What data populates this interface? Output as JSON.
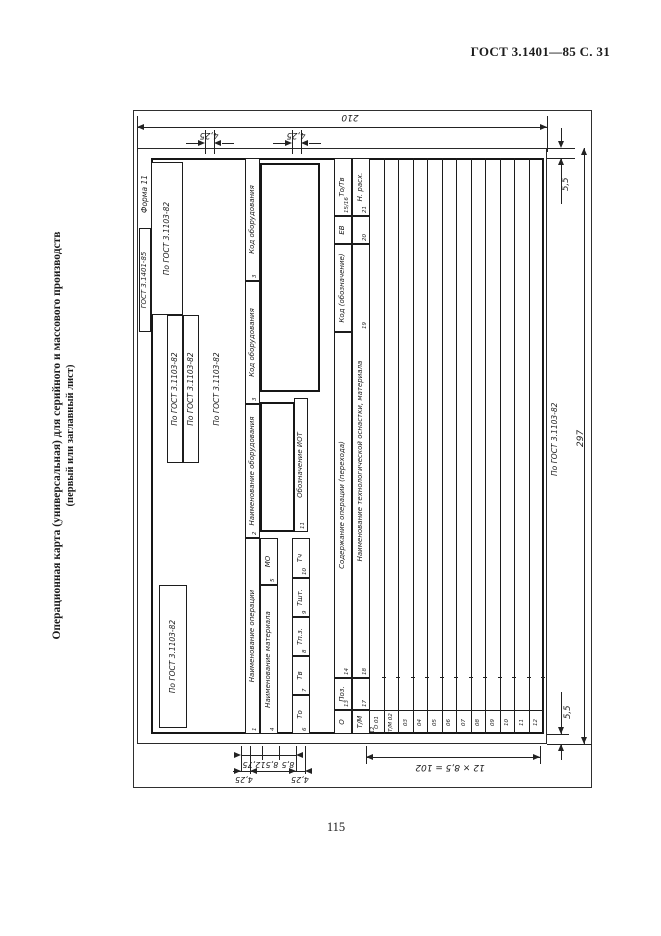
{
  "page": {
    "header": "ГОСТ 3.1401—85 С. 31",
    "page_number": "115",
    "side_title_line1": "Операционная карта (универсальная) для серийного и массового производств",
    "side_title_line2": "(первый или заглавный лист)"
  },
  "form": {
    "forma_label": "Форма 11",
    "designation_box": "ГОСТ 3.1401-85",
    "stamp_box_a": "По ГОСТ 3.1103-82",
    "stamp_box_b1": "По ГОСТ 3.1103-82",
    "stamp_box_b2": "По ГОСТ 3.1103-82",
    "stamp_box_c": "По ГОСТ 3.1103-82",
    "zone_note": "По ГОСТ 3.1103-82",
    "op_name": "Наименование операции",
    "equip_name": "Наименование оборудования",
    "equip_code1": "Код оборудования",
    "equip_code2": "Код оборудования",
    "mat_name": "Наименование материала",
    "mo": "МО",
    "times": [
      {
        "label": "То",
        "num": "6"
      },
      {
        "label": "Тв",
        "num": "7"
      },
      {
        "label": "Тп.з.",
        "num": "8"
      },
      {
        "label": "Тшт.",
        "num": "9"
      },
      {
        "label": "Тч",
        "num": "10"
      }
    ],
    "iot": "Обозначение ИОТ",
    "row_o": {
      "letter": "О",
      "pos": "Поз.",
      "content": "Содержание операции (перехода)",
      "code": "Код (обозначение)",
      "ev": "ЕВ",
      "totv": "То/Тв"
    },
    "row_tm": {
      "letter": "Т/М",
      "content": "Наименование технологической оснастки, материала",
      "rate": "Н. расх."
    },
    "graph_numbers": {
      "op": "1",
      "equip": "2",
      "code1": "3",
      "code2": "3",
      "mat": "4",
      "mo": "5",
      "iot": "11",
      "service": "12",
      "pos_o": "13",
      "content_o": "14",
      "totv_o": "15/16",
      "pos_tm": "17",
      "content_tm": "18",
      "code_tm": "19",
      "ev_tm": "20",
      "totv_tm": "21"
    },
    "lines": [
      {
        "label": "О 01",
        "g": "12"
      },
      {
        "label": "Т/М 02",
        "g": ""
      },
      {
        "label": "03",
        "g": ""
      },
      {
        "label": "04",
        "g": ""
      },
      {
        "label": "05",
        "g": ""
      },
      {
        "label": "06",
        "g": ""
      },
      {
        "label": "07",
        "g": ""
      },
      {
        "label": "08",
        "g": ""
      },
      {
        "label": "09",
        "g": ""
      },
      {
        "label": "10",
        "g": ""
      },
      {
        "label": "11",
        "g": ""
      },
      {
        "label": "12",
        "g": ""
      }
    ]
  },
  "dimensions": {
    "sheet_width": "210",
    "sheet_height": "297",
    "margin_right": "5,5",
    "margin_left": "5,5",
    "top_1": "4,25",
    "top_2": "4,25",
    "bottom_1": "12,75",
    "bottom_2": "8,5",
    "bottom_3": "8,5",
    "bottom_4": "4,25",
    "bottom_5": "4,25",
    "body_rows": "12 × 8,5 = 102",
    "side_note": "По ГОСТ 3.1103-82"
  }
}
